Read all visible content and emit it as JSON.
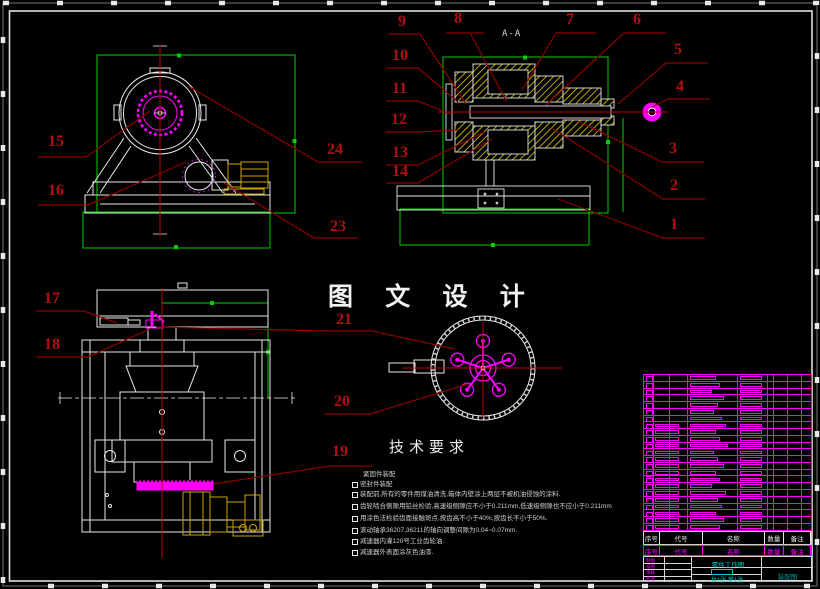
{
  "app": {
    "background": "#000000"
  },
  "frame": {
    "border_color": "#e8e8e8"
  },
  "colors": {
    "green": "#00cc00",
    "magenta": "#ff00ff",
    "motor_yellow": "#c9a400",
    "hatch_yellow": "#d6c500",
    "leader_red": "#8b0000",
    "centerline_red": "#c00000",
    "callout_text": "#b01010",
    "cyan_text": "#00c8c8"
  },
  "main_title": "图 文 设 计",
  "section_label": "A-A",
  "tech": {
    "title": "技术要求",
    "items": [
      {
        "bullet": false,
        "text": "紧固件装配"
      },
      {
        "bullet": true,
        "text": "密封件装配"
      },
      {
        "bullet": true,
        "text": "装配前,所有的零件用煤油清洗,箱体内壁涂上两层不被机油侵蚀的涂料."
      },
      {
        "bullet": true,
        "text": "齿轮啮合侧隙用铅丝检验,高速级侧隙应不小于0.211mm,低速级侧隙也不应小于0.211mm"
      },
      {
        "bullet": true,
        "text": "用涂色法检验齿面接触斑点,按齿高不小于40%,按齿长不小于50%."
      },
      {
        "bullet": true,
        "text": "滚动轴承36207,36211的轴向调整间隙为0.04~0.07mm."
      },
      {
        "bullet": true,
        "text": "减速器内灌120号工业齿轮油."
      },
      {
        "bullet": true,
        "text": "减速器外表面涂灰色油漆."
      }
    ]
  },
  "callouts": {
    "c1": "1",
    "c2": "2",
    "c3": "3",
    "c4": "4",
    "c5": "5",
    "c6": "6",
    "c7": "7",
    "c8": "8",
    "c9": "9",
    "c10": "10",
    "c11": "11",
    "c12": "12",
    "c13": "13",
    "c14": "14",
    "c15": "15",
    "c16": "16",
    "c17": "17",
    "c18": "18",
    "c19": "19",
    "c20": "20",
    "c21": "21",
    "c23": "23",
    "c24": "24"
  },
  "bom": {
    "row_count": 23,
    "block_widths": [
      26,
      30,
      22,
      34,
      28,
      24,
      32,
      36,
      26,
      30,
      38,
      24,
      28,
      34,
      26,
      30,
      22,
      36,
      28,
      32,
      26,
      34,
      30
    ],
    "header_white": [
      "序号",
      "代号",
      "名称",
      "数量",
      "备注"
    ],
    "header_magenta": [
      "序号",
      "代号",
      "名称",
      "数量",
      "备注"
    ],
    "titleblock": {
      "left_labels": [
        "制图",
        "描图",
        "审核",
        "批准"
      ],
      "doc_title": "零件工作图",
      "sheet_info": "共1张 第1张",
      "drawing_type": "装配图"
    }
  }
}
